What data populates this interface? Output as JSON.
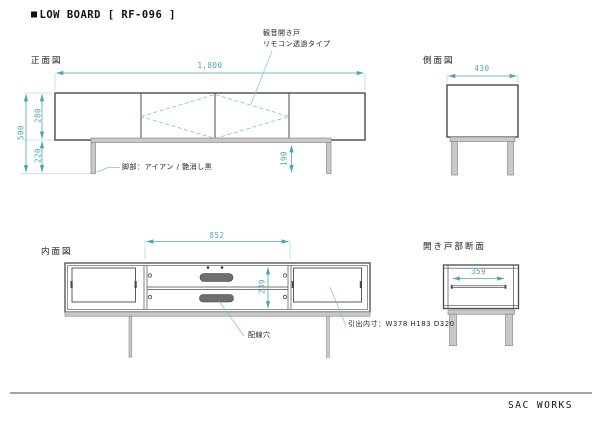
{
  "page": {
    "title": {
      "bullet": "■",
      "text": "LOW BOARD [ RF-096 ]"
    },
    "footer": "SAC WORKS"
  },
  "colors": {
    "dimension_teal": "#4da5b5",
    "drawing_line": "#4a4a4a",
    "leg_fill": "#c9c9c9",
    "wiring_hole_fill": "#6e6e6e",
    "background": "#ffffff"
  },
  "views": {
    "front": {
      "label": "正面図",
      "dims": {
        "width": "1,800",
        "body_height": "280",
        "total_height": "500",
        "leg_height": "220",
        "leg_clearance": "190"
      },
      "annotations": {
        "door": [
          "観音開き戸",
          "リモコン透過タイプ"
        ],
        "leg": "脚部：アイアン / 艶消し黒"
      }
    },
    "side": {
      "label": "側面図",
      "dims": {
        "depth": "430"
      }
    },
    "inner": {
      "label": "内面図",
      "dims": {
        "center_width": "852",
        "inner_height": "239"
      },
      "annotations": {
        "wiring_hole": "配線穴",
        "drawer": "引出内寸：W378 H183 D320"
      }
    },
    "section": {
      "label": "開き戸部断面",
      "dims": {
        "inner_depth": "359"
      }
    }
  }
}
